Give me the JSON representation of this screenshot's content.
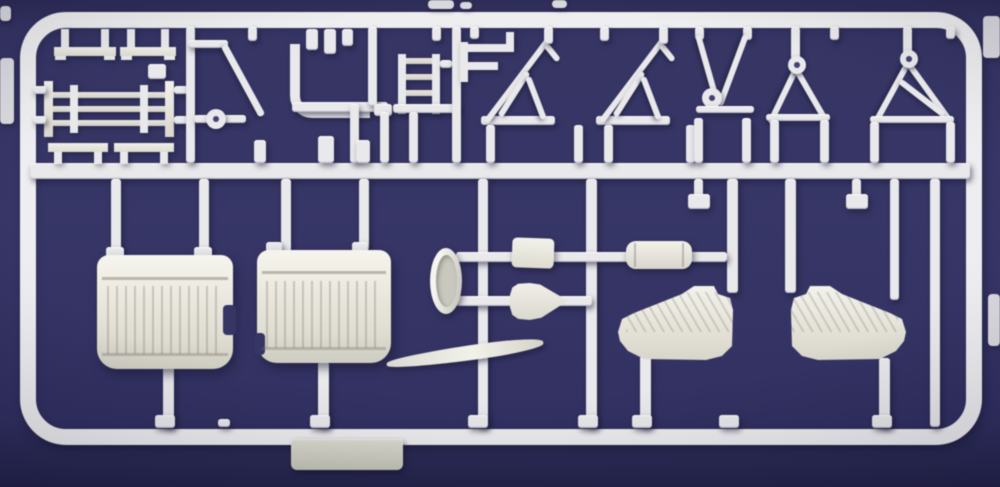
{
  "scene": {
    "description": "Photograph of a white injection-molded plastic model kit sprue (parts tree) on a dark navy blue background",
    "colors": {
      "sprue": "#e8e7ea",
      "part": "#e9e7dc",
      "bg": "#2b2a5c",
      "bg-edge": "#1b1a43",
      "shadow": "rgba(12,12,38,0.55)"
    },
    "parts_inventory": [
      {
        "name": "bench-bracket",
        "count": 4,
        "area": "top-left"
      },
      {
        "name": "engine-cylinder-block",
        "count": 1,
        "area": "top-left"
      },
      {
        "name": "diagonal-strut",
        "count": 1,
        "area": "top-left"
      },
      {
        "name": "ball-joint-rod",
        "count": 1,
        "area": "top-left"
      },
      {
        "name": "l-shaped-pipe",
        "count": 1,
        "area": "top-middle"
      },
      {
        "name": "small-tab",
        "count": 6,
        "area": "top-middle"
      },
      {
        "name": "ladder-frame",
        "count": 1,
        "area": "top-middle"
      },
      {
        "name": "f-bracket",
        "count": 1,
        "area": "top-middle"
      },
      {
        "name": "wing-strut-assembly",
        "count": 2,
        "area": "top-middle"
      },
      {
        "name": "landing-gear-v-strut",
        "count": 3,
        "area": "top-right"
      },
      {
        "name": "engine-cowling-half",
        "count": 2,
        "area": "bottom-left"
      },
      {
        "name": "cowl-ring-disc",
        "count": 1,
        "area": "bottom-middle"
      },
      {
        "name": "small-block",
        "count": 1,
        "area": "bottom-middle"
      },
      {
        "name": "headrest-fairing",
        "count": 1,
        "area": "bottom-middle"
      },
      {
        "name": "fuel-tank-cylinder",
        "count": 1,
        "area": "bottom-middle"
      },
      {
        "name": "propeller-blade",
        "count": 1,
        "area": "bottom-middle"
      },
      {
        "name": "cowl-side-panel",
        "count": 2,
        "area": "bottom-right"
      },
      {
        "name": "molding-tab-plate",
        "count": 1,
        "area": "bottom-edge"
      }
    ]
  }
}
